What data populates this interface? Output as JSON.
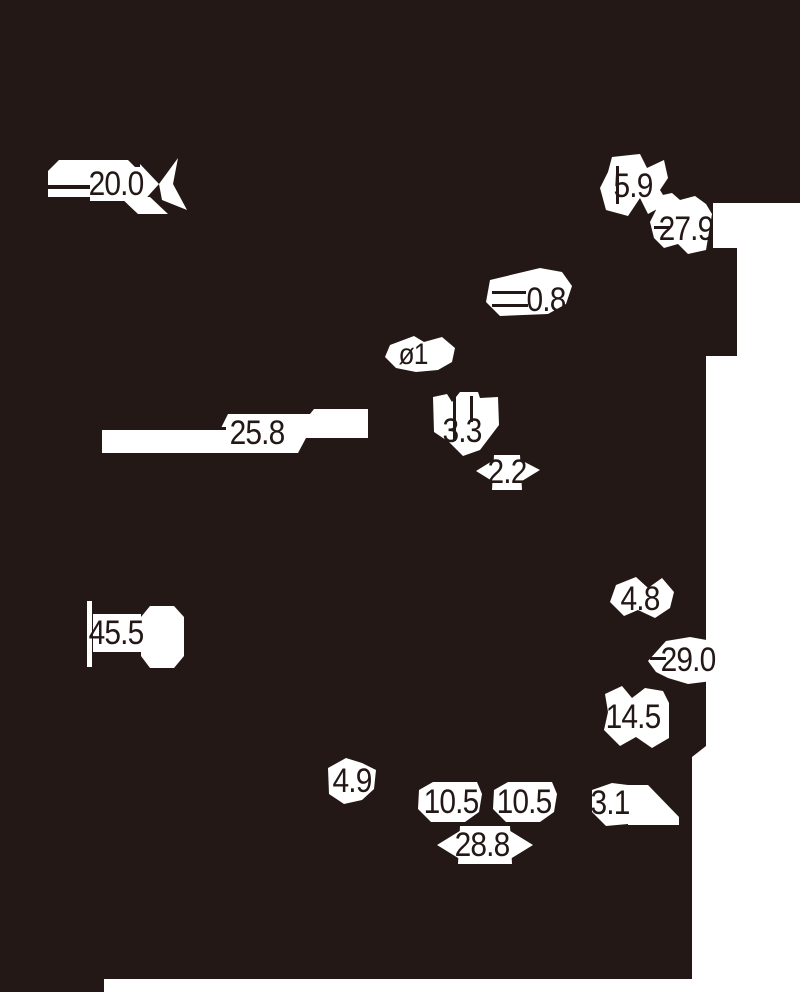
{
  "drawing": {
    "type": "technical-drawing-dimension-callouts",
    "background_color": "#231815",
    "halo_color": "#ffffff",
    "ink_color": "#231815",
    "dimensions": [
      {
        "label": "20.0"
      },
      {
        "label": "5.9"
      },
      {
        "label": "27.9"
      },
      {
        "label": "0.8"
      },
      {
        "label": "ø1"
      },
      {
        "label": "3.3"
      },
      {
        "label": "2.2"
      },
      {
        "label": "25.8"
      },
      {
        "label": "4.8"
      },
      {
        "label": "29.0"
      },
      {
        "label": "45.5"
      },
      {
        "label": "14.5"
      },
      {
        "label": "4.9"
      },
      {
        "label": "10.5"
      },
      {
        "label": "10.5"
      },
      {
        "label": "3.1"
      },
      {
        "label": "28.8"
      }
    ]
  }
}
